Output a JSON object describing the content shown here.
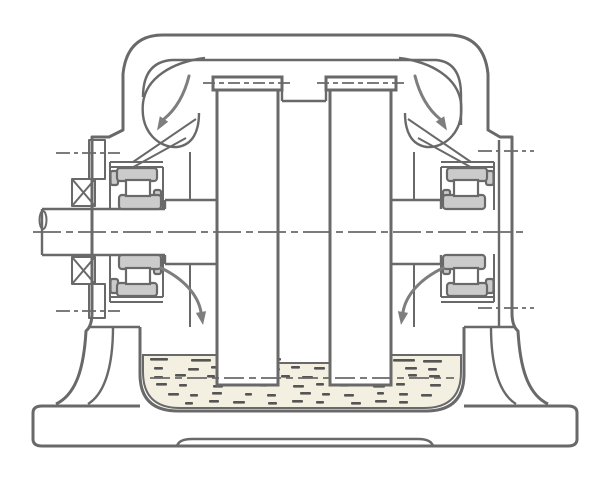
{
  "diagram": {
    "type": "technical-cross-section",
    "subject": "gear-unit-housing-with-oil-splash-lubrication",
    "parts": {
      "housing": "housing-outline",
      "left_wheel": "left-gear-wheel",
      "right_wheel": "right-gear-wheel",
      "shaft": "input-shaft",
      "bearings": [
        "upper-left-bearing",
        "lower-left-bearing",
        "upper-right-bearing",
        "lower-right-bearing"
      ],
      "seal": "left-shaft-seal-gland",
      "cover": "right-end-cover",
      "oil_sump": "oil-sump",
      "oil_level_line": "oil-level-centerline",
      "arrows": [
        "oil-flow-arrow-top-left",
        "oil-flow-arrow-top-right",
        "oil-drain-arrow-bottom-left",
        "oil-drain-arrow-bottom-right"
      ],
      "baseplate": "baseplate"
    }
  },
  "colors": {
    "background": "#ffffff",
    "line": "#696969",
    "line_light": "#7e7e7e",
    "bearing_fill": "#cbcbcb",
    "roller_fill": "#ffffff",
    "wheel_fill": "#ffffff",
    "oil_fill": "#f3f0e1",
    "oil_dash": "#555555"
  }
}
